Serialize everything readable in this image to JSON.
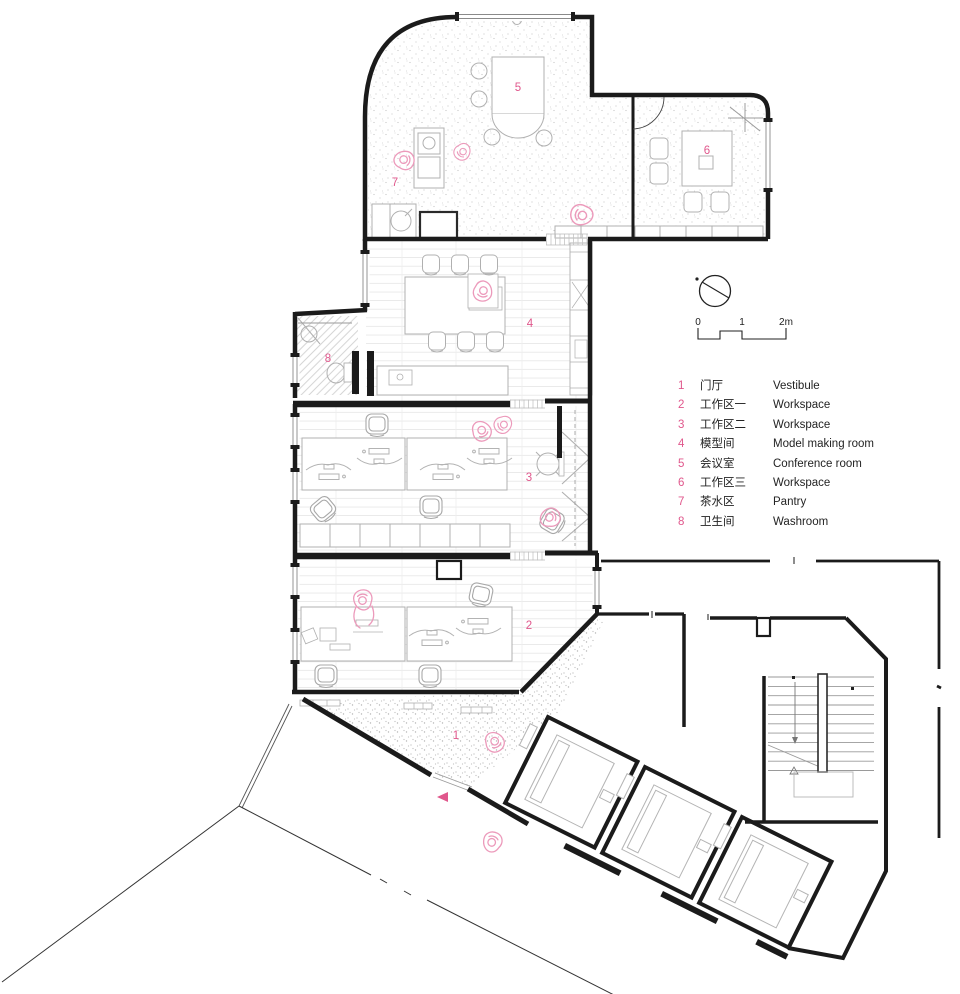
{
  "plan": {
    "room_numbers": {
      "r1": "1",
      "r2": "2",
      "r3": "3",
      "r4": "4",
      "r5": "5",
      "r6": "6",
      "r7": "7",
      "r8": "8"
    }
  },
  "scale_bar": {
    "tick0": "0",
    "tick1": "1",
    "tick2": "2m"
  },
  "legend": {
    "rows": [
      {
        "num": "1",
        "zh": "门厅",
        "en": "Vestibule"
      },
      {
        "num": "2",
        "zh": "工作区一",
        "en": "Workspace"
      },
      {
        "num": "3",
        "zh": "工作区二",
        "en": "Workspace"
      },
      {
        "num": "4",
        "zh": "模型间",
        "en": "Model making room"
      },
      {
        "num": "5",
        "zh": "会议室",
        "en": "Conference room"
      },
      {
        "num": "6",
        "zh": "工作区三",
        "en": "Workspace"
      },
      {
        "num": "7",
        "zh": "茶水区",
        "en": "Pantry"
      },
      {
        "num": "8",
        "zh": "卫生间",
        "en": "Washroom"
      }
    ]
  },
  "colors": {
    "accent_pink": "#e0578c",
    "figure_pink": "#ec9abb",
    "wall_black": "#1b1b1b"
  }
}
